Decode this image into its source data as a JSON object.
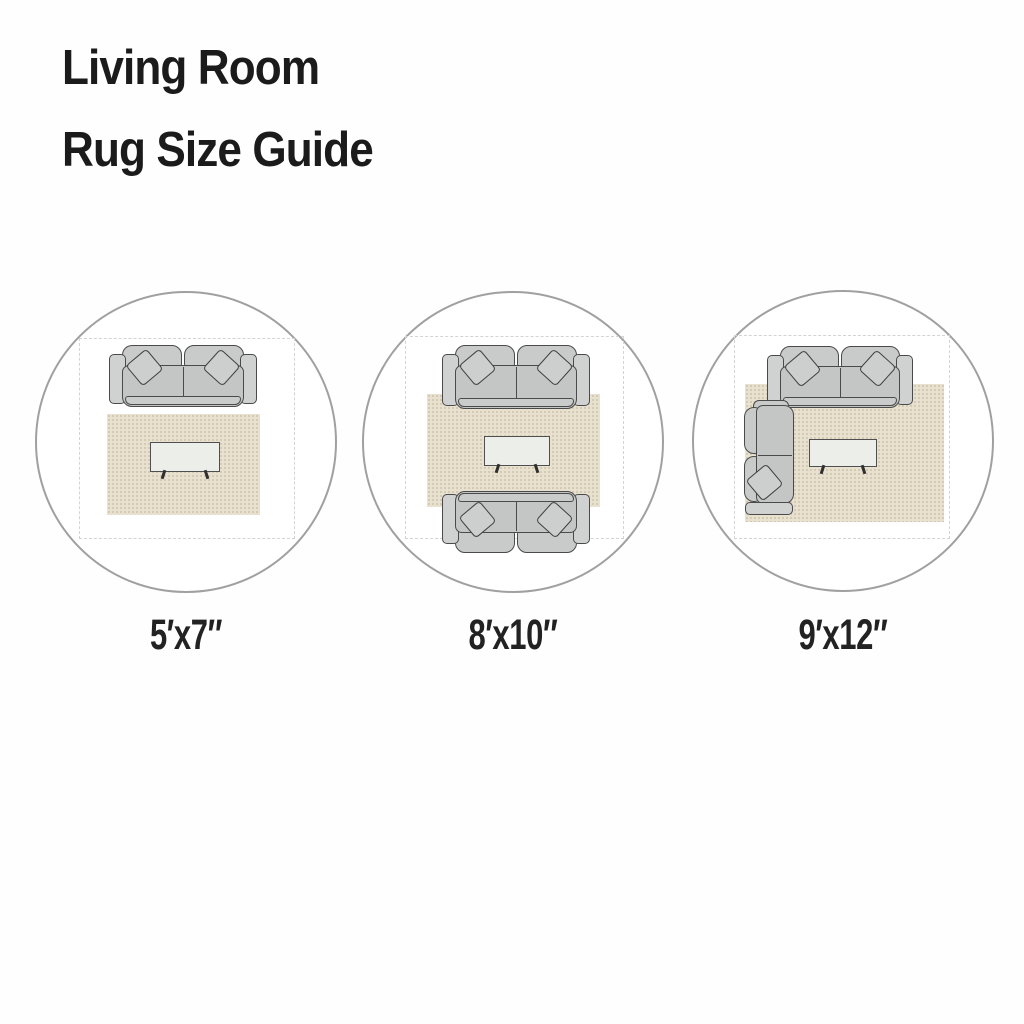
{
  "title": {
    "line1": "Living Room",
    "line2": "Rug Size Guide"
  },
  "diagrams": [
    {
      "id": "rug-5x7",
      "size_label": "5′x7″",
      "furniture": [
        "sofa",
        "throw-pillows",
        "rug",
        "coffee-table",
        "room-outline"
      ],
      "layout_note": "rug sits fully in front of the sofa"
    },
    {
      "id": "rug-8x10",
      "size_label": "8′x10″",
      "furniture": [
        "sofa",
        "facing-sofa",
        "throw-pillows",
        "rug",
        "coffee-table",
        "room-outline"
      ],
      "layout_note": "two facing sofas with front legs on the rug"
    },
    {
      "id": "rug-9x12",
      "size_label": "9′x12″",
      "furniture": [
        "sectional-sofa",
        "throw-pillows",
        "rug",
        "coffee-table",
        "room-outline"
      ],
      "layout_note": "sectional sofa sitting on the rug"
    }
  ],
  "colors": {
    "background": "#fefefe",
    "title_text": "#1b1b1b",
    "label_text": "#222222",
    "circle_border": "#a0a0a0",
    "room_dash": "#d3d3d3",
    "sofa_fill": "#c5c7c6",
    "sofa_outline": "#4a4a4a",
    "rug_fill": "#e9e1cf",
    "table_fill": "#eceee9"
  }
}
